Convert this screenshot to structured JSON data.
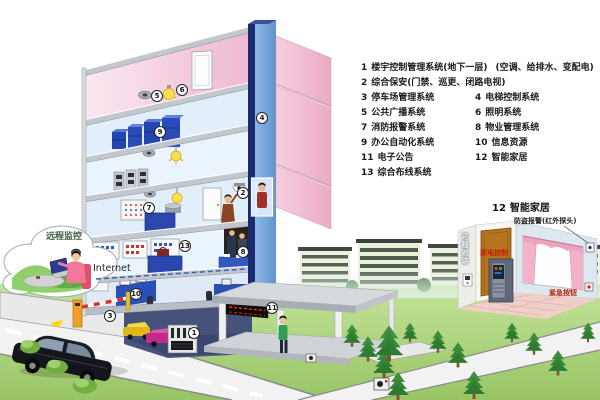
{
  "palette": {
    "building_pink": "#f4cede",
    "interior_blue": "#e6f1fa",
    "shaft_front": "#6fa5d8",
    "shaft_edge": "#1c2b6e",
    "slab_gray": "#c2c7cd",
    "grass_green": "#aed581",
    "road_gray": "#f1f1f1",
    "cabinet_blue": "#2a47ad",
    "led_red": "#ff2a00",
    "label_red": "#c22000",
    "legend_text": "#1a1a1a"
  },
  "legend": {
    "items": [
      {
        "num": "1",
        "label": "楼宇控制管理系统(地下一层)",
        "note": "(空调、给排水、变配电)"
      },
      {
        "num": "2",
        "label": "综合保安(门禁、巡更、闭路电视)"
      },
      {
        "num": "3",
        "label": "停车场管理系统"
      },
      {
        "num": "4",
        "label": "电梯控制系统"
      },
      {
        "num": "5",
        "label": "公共广播系统"
      },
      {
        "num": "6",
        "label": "照明系统"
      },
      {
        "num": "7",
        "label": "消防报警系统"
      },
      {
        "num": "8",
        "label": "物业管理系统"
      },
      {
        "num": "9",
        "label": "办公自动化系统"
      },
      {
        "num": "10",
        "label": "信息资源"
      },
      {
        "num": "11",
        "label": "电子公告"
      },
      {
        "num": "12",
        "label": "智能家居"
      },
      {
        "num": "13",
        "label": "综合布线系统"
      }
    ]
  },
  "floor_markers": [
    "1",
    "2",
    "3",
    "4",
    "5",
    "6",
    "7",
    "8",
    "9",
    "10",
    "11",
    "13"
  ],
  "cloud": {
    "label": "远程监控"
  },
  "network": {
    "internet_label": "Internet"
  },
  "smart_home": {
    "num": "12",
    "title": "智能家居",
    "intercom": "可视对讲",
    "appliance_control": "家电控制",
    "burglar_alarm": "防盗报警(红外探头)",
    "emergency_button": "紧急按钮"
  }
}
